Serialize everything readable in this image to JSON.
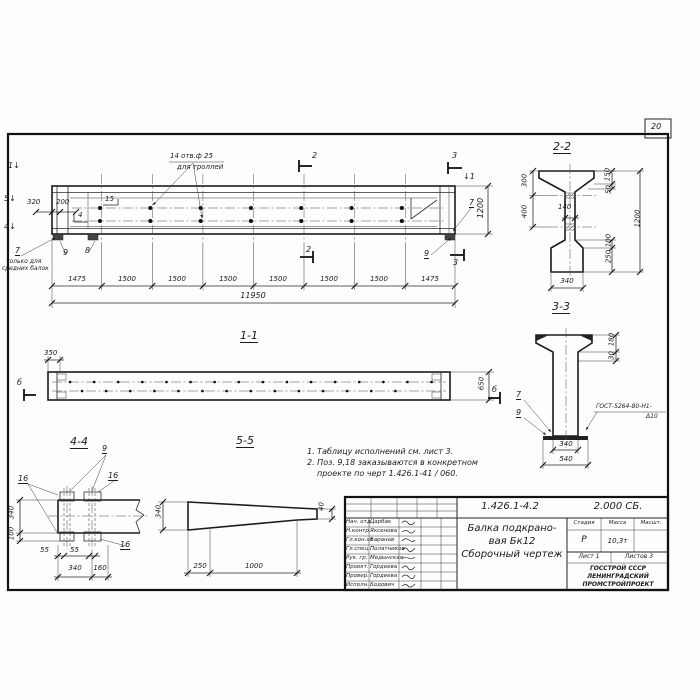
{
  "sheet": {
    "page_number": "20"
  },
  "main_view": {
    "arrow_1": "1↓",
    "arrow_5": "5↓",
    "arrow_4": "4↓",
    "arrow_1_right": "↓1",
    "dim_320": "320",
    "dim_200": "200",
    "callout_15": "15",
    "callout_4": "4",
    "holes_note_line1": "14 отв.ф 25",
    "holes_note_line2": "для троллей",
    "callout_7": "7",
    "note_7_line1": "только для",
    "note_7_line2": "средних балок",
    "callout_9": "9",
    "callout_8": "8",
    "cut_2_top": "2",
    "cut_2_bottom": "2",
    "cut_3_top": "3",
    "cut_3_bottom": "3",
    "dim_1200": "1200",
    "callout_7_right": "7",
    "callout_9_right": "9",
    "bottom_dims": [
      "1475",
      "1500",
      "1500",
      "1500",
      "1500",
      "1500",
      "1500",
      "1475"
    ],
    "dim_total": "11950"
  },
  "section_2_2": {
    "title": "2-2",
    "dim_300": "300",
    "dim_400": "400",
    "dim_140": "140",
    "dim_150": "150",
    "dim_50": "50",
    "dim_1200": "1200",
    "dim_100": "100",
    "dim_250": "250",
    "dim_340": "340"
  },
  "section_3_3": {
    "title": "3-3",
    "dim_180": "180",
    "dim_30": "30",
    "callout_7": "7",
    "callout_9": "9",
    "weld_note_line1": "ГОСТ-5264-80-Н1-",
    "weld_note_line2": "Δ10",
    "dim_340": "340",
    "dim_540": "540"
  },
  "section_1_1": {
    "title": "1-1",
    "dim_350": "350",
    "dim_650": "650",
    "mark_left": "б",
    "mark_right": "б"
  },
  "section_4_4": {
    "title": "4-4",
    "callout_9": "9",
    "callout_16_left": "16",
    "callout_16_right": "16",
    "callout_16_bottom": "16",
    "dim_340_side": "340",
    "dim_100": "100",
    "dim_55_a": "55",
    "dim_55_b": "55",
    "dim_340_bottom": "340",
    "dim_160": "160"
  },
  "section_5_5": {
    "title": "5-5",
    "dim_340": "340",
    "dim_40": "40",
    "dim_250": "250",
    "dim_1000": "1000"
  },
  "notes": {
    "line1": "1. Таблицу исполнений  см. лист 3.",
    "line2": "2. Поз. 9,18 заказываются в конкретном",
    "line3": "проекте по черт 1.426.1-41 / 060."
  },
  "title_block": {
    "doc_number": "1.426.1-4.2",
    "doc_code": "2.000 СБ.",
    "rows": [
      {
        "role": "Нач. отд",
        "name": "Царбак"
      },
      {
        "role": "Н.контр.",
        "name": "Яксенова"
      },
      {
        "role": "Гл.кон.от",
        "name": "Баранов"
      },
      {
        "role": "Гл.спец.",
        "name": "Полатников"
      },
      {
        "role": "Рук. гр.",
        "name": "Медынская"
      },
      {
        "role": "Проект.",
        "name": "Гордеева"
      },
      {
        "role": "Провер.",
        "name": "Гордеева"
      },
      {
        "role": "Исполн.",
        "name": "Бодович"
      }
    ],
    "title_line1": "Балка подкрано-",
    "title_line2": "вая Бк12",
    "title_line3": "Сборочный чертеж",
    "col_stage": "Стадия",
    "col_mass": "Масса",
    "col_scale": "Масшт.",
    "stage": "Р",
    "mass": "10,3т",
    "sheet_label": "Лист 1",
    "sheets_label": "Листов 3",
    "org_line1": "ГОССТРОЙ СССР",
    "org_line2": "ЛЕНИНГРАДСКИЙ",
    "org_line3": "ПРОМСТРОЙПРОЕКТ"
  }
}
